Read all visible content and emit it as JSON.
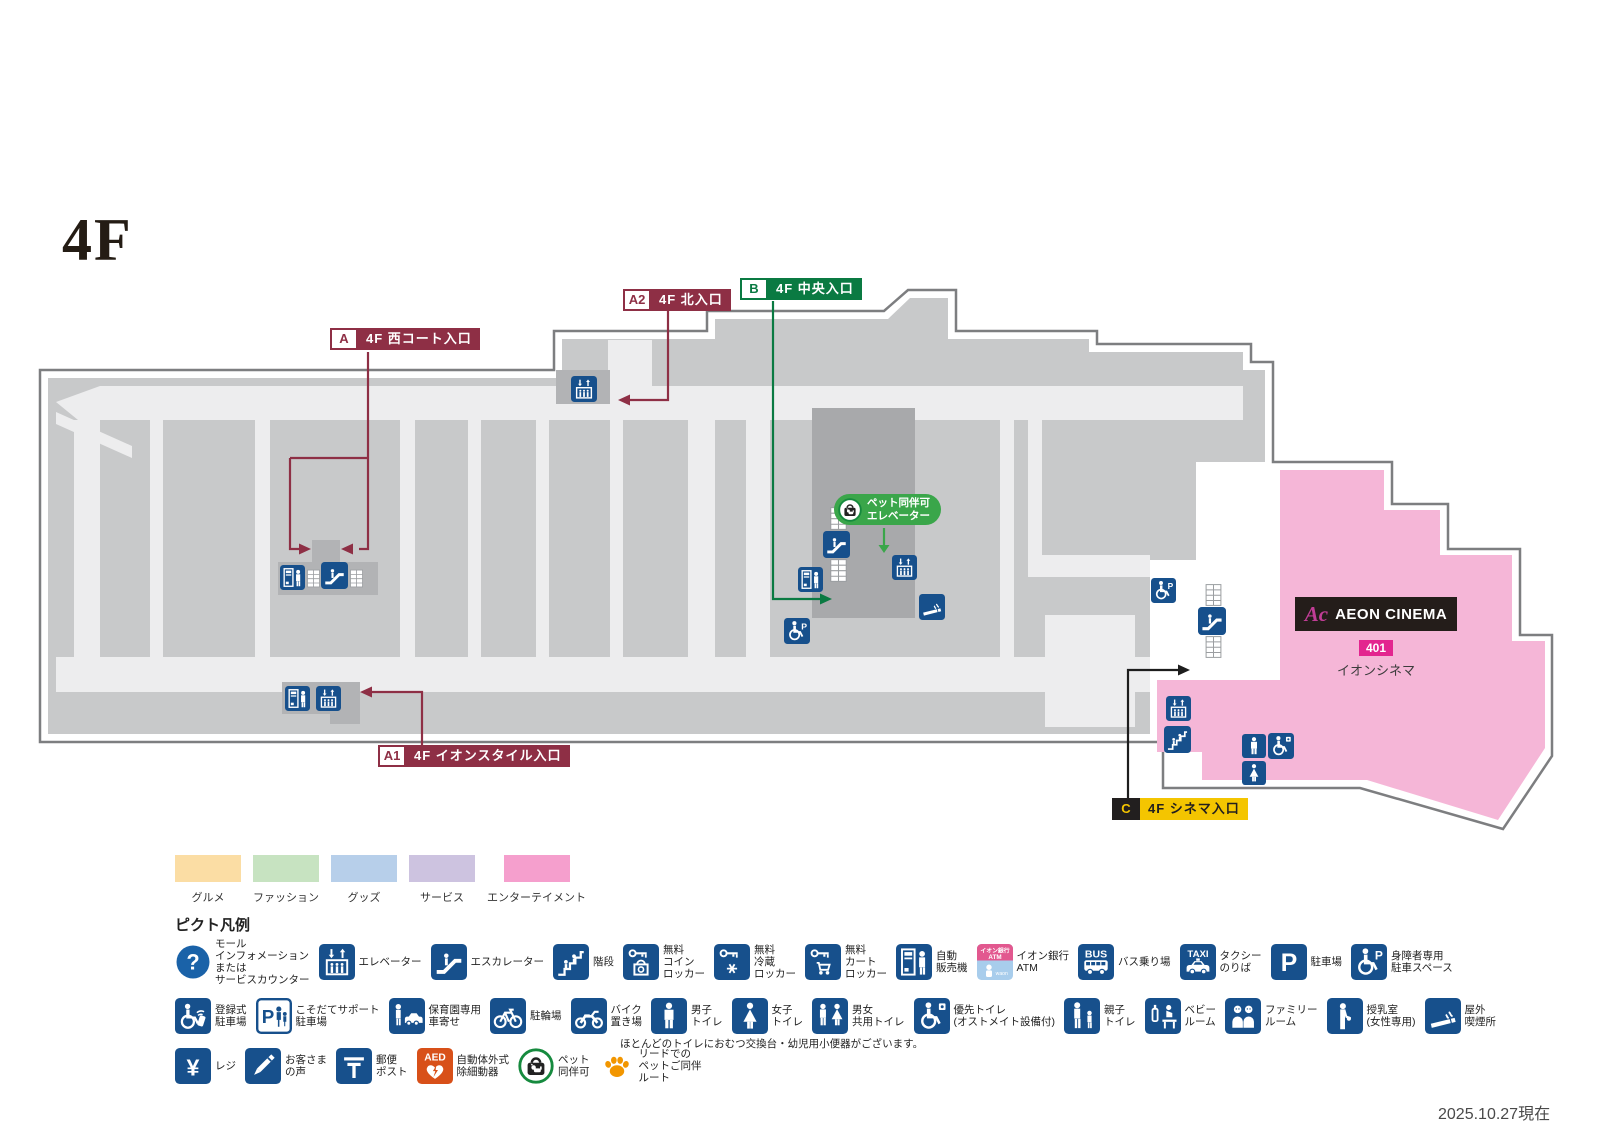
{
  "floor_title": "4F",
  "as_of": "2025.10.27現在",
  "entrances": [
    {
      "id": "A",
      "label": "4F 西コート入口"
    },
    {
      "id": "A2",
      "label": "4F 北入口"
    },
    {
      "id": "B",
      "label": "4F 中央入口"
    },
    {
      "id": "A1",
      "label": "4F イオンスタイル入口"
    },
    {
      "id": "C",
      "label": "4F シネマ入口"
    }
  ],
  "pet_elevator": {
    "line1": "ペット同伴可",
    "line2": "エレベーター"
  },
  "cinema": {
    "logo_mark": "Ac",
    "logo_text": "AEON CINEMA",
    "unit_no": "401",
    "unit_name": "イオンシネマ"
  },
  "category_legend": [
    {
      "label": "グルメ",
      "color": "#fbdda4"
    },
    {
      "label": "ファッション",
      "color": "#c7e3c1"
    },
    {
      "label": "グッズ",
      "color": "#b7cfea"
    },
    {
      "label": "サービス",
      "color": "#cdc3e0"
    },
    {
      "label": "エンターテイメント",
      "color": "#f59fcd"
    }
  ],
  "picto_legend": {
    "title": "ピクト凡例",
    "note": "ほとんどのトイレにおむつ交換台・幼児用小便器がございます。",
    "rows": [
      [
        {
          "icon": "mall-information",
          "label": "モール\nインフォメーション\nまたは\nサービスカウンター"
        },
        {
          "icon": "elevator",
          "label": "エレベーター"
        },
        {
          "icon": "escalator",
          "label": "エスカレーター"
        },
        {
          "icon": "stairs",
          "label": "階段"
        },
        {
          "icon": "coin-locker",
          "label": "無料\nコイン\nロッカー"
        },
        {
          "icon": "cold-locker",
          "label": "無料\n冷蔵\nロッカー"
        },
        {
          "icon": "cart-locker",
          "label": "無料\nカート\nロッカー"
        },
        {
          "icon": "vending-machine",
          "label": "自動\n販売機"
        },
        {
          "icon": "aeon-bank-atm",
          "label": "イオン銀行\nATM"
        },
        {
          "icon": "bus-stop",
          "label": "バス乗り場"
        },
        {
          "icon": "taxi-stand",
          "label": "タクシー\nのりば"
        },
        {
          "icon": "parking",
          "label": "駐車場"
        },
        {
          "icon": "accessible-parking",
          "label": "身障者専用\n駐車スペース"
        }
      ],
      [
        {
          "icon": "registered-parking",
          "label": "登録式\n駐車場"
        },
        {
          "icon": "kosodate-support-parking",
          "label": "こそだてサポート\n駐車場"
        },
        {
          "icon": "nursery-pickup",
          "label": "保育園専用\n車寄せ"
        },
        {
          "icon": "bicycle-parking",
          "label": "駐輪場"
        },
        {
          "icon": "motorcycle-parking",
          "label": "バイク\n置き場"
        },
        {
          "icon": "mens-toilet",
          "label": "男子\nトイレ"
        },
        {
          "icon": "womens-toilet",
          "label": "女子\nトイレ"
        },
        {
          "icon": "all-gender-toilet",
          "label": "男女\n共用トイレ"
        },
        {
          "icon": "priority-toilet",
          "label": "優先トイレ\n(オストメイト設備付)"
        },
        {
          "icon": "parent-child-toilet",
          "label": "親子\nトイレ"
        },
        {
          "icon": "baby-room",
          "label": "ベビー\nルーム"
        },
        {
          "icon": "family-room",
          "label": "ファミリー\nルーム"
        },
        {
          "icon": "nursing-room",
          "label": "授乳室\n(女性専用)"
        },
        {
          "icon": "outdoor-smoking",
          "label": "屋外\n喫煙所"
        }
      ],
      [
        {
          "icon": "cashier",
          "label": "レジ"
        },
        {
          "icon": "customer-voice",
          "label": "お客さま\nの声"
        },
        {
          "icon": "post-box",
          "label": "郵便\nポスト"
        },
        {
          "icon": "aed",
          "label": "自動体外式\n除細動器"
        },
        {
          "icon": "pet-allowed",
          "label": "ペット\n同伴可"
        },
        {
          "icon": "pet-route",
          "label": "リードでの\nペットご同伴\nルート"
        }
      ]
    ]
  }
}
